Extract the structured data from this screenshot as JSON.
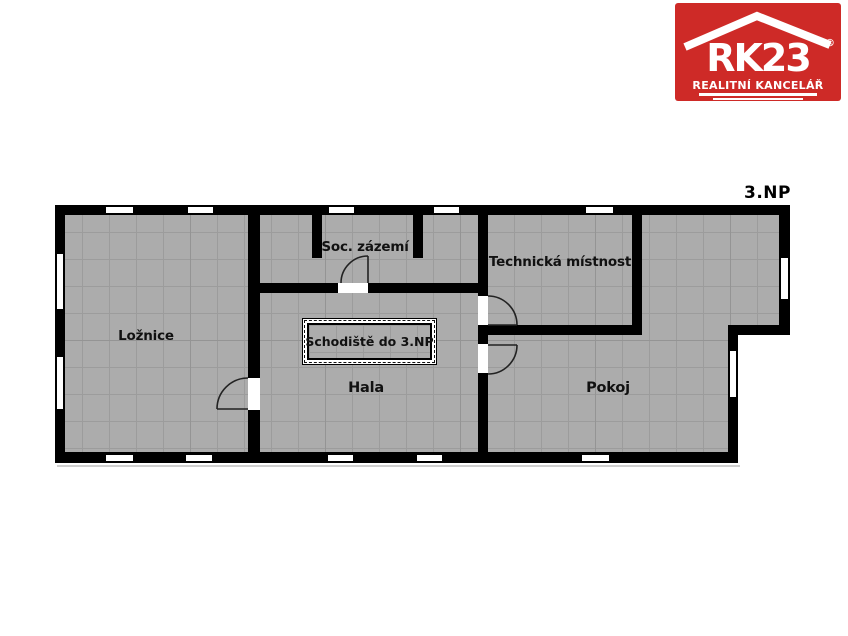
{
  "floor_plan": {
    "floor_label": "3.NP",
    "rooms": [
      {
        "name": "Ložnice"
      },
      {
        "name": "Soc. zázemí"
      },
      {
        "name": "Technická místnost"
      },
      {
        "name": "Hala"
      },
      {
        "name": "Pokoj"
      }
    ],
    "staircase_label": "Schodiště do 3.NP"
  },
  "logo": {
    "brand": "RK23",
    "registered": "®",
    "tagline": "REALITNÍ KANCELÁŘ"
  },
  "colors": {
    "page_background": "#ffffff",
    "wall": "#000000",
    "floor": "#acacac",
    "grid_line": "#9c9c9c",
    "grid_line_major": "#949494",
    "label_text": "#111111",
    "logo_red": "#ce2a27",
    "logo_white": "#ffffff"
  }
}
